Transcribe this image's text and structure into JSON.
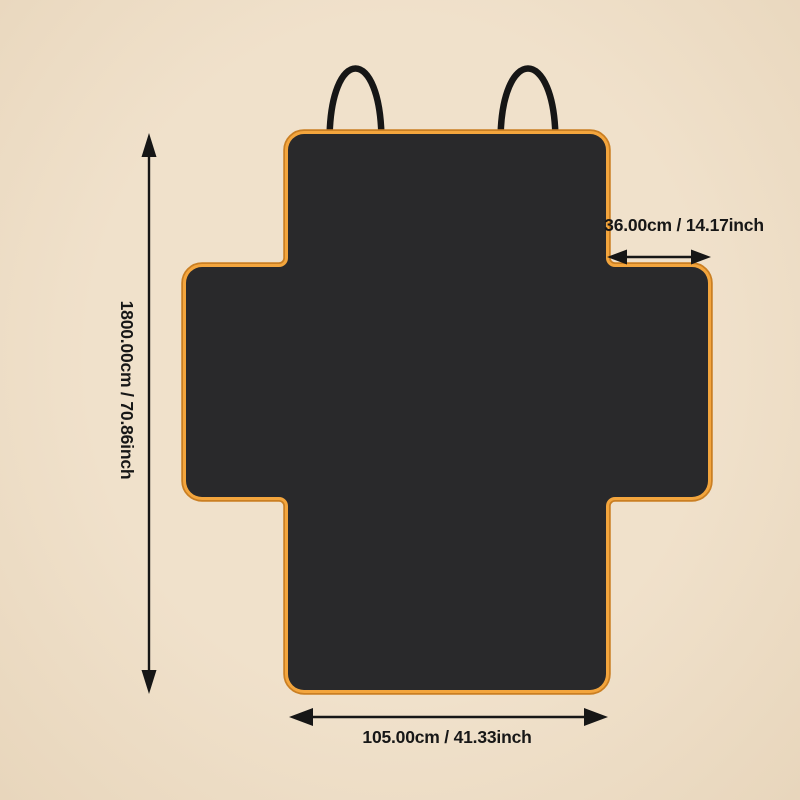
{
  "colors": {
    "background": "#efe0ca",
    "cover_fill": "#29292b",
    "trim": "#f3a53d",
    "trim_edge": "#ca7f23",
    "ink": "#161616"
  },
  "annotations": {
    "height": {
      "label": "1800.00cm / 70.86inch",
      "arrow": "double-headed-vertical-arrow"
    },
    "flap_width": {
      "label": "36.00cm / 14.17inch",
      "arrow": "double-headed-horizontal-arrow"
    },
    "seat_width": {
      "label": "105.00cm / 41.33inch",
      "arrow": "double-headed-horizontal-arrow"
    }
  }
}
